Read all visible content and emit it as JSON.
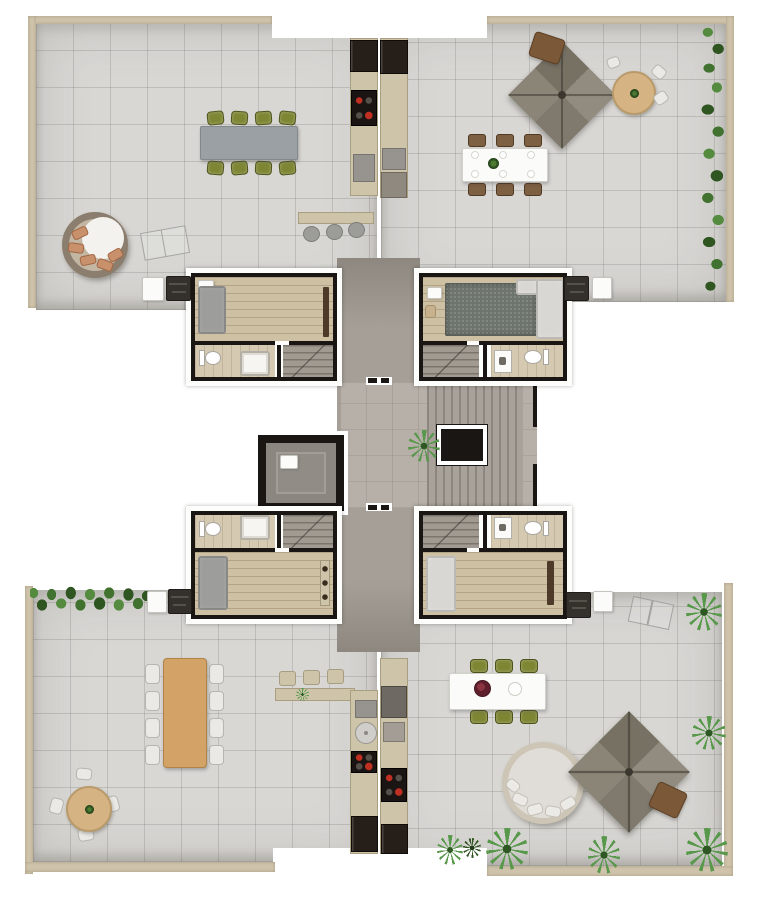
{
  "scene": {
    "kind": "rendered-floor-plan-top-view",
    "description_items": [
      "four terrace units",
      "central elevator and stair core",
      "no text labels visible"
    ]
  },
  "palette": {
    "wall_beige": "#cfc3ab",
    "tile": "#d8d7d4",
    "tile_line": "rgba(125,122,116,0.28)",
    "core": "#a59f97",
    "corridor": "#b6b0a8",
    "wood_floor": "#cec0a3",
    "wood_table": "#d3a267",
    "table_gray": "#9aa0a3",
    "chair_green": "#7e8634",
    "chair_brown": "#7d5f41",
    "chair_white": "#eae9e5",
    "hedge_dark": "#2f5521",
    "hedge_mid": "#41722f",
    "hedge_light": "#558b3f",
    "palm_green": "#57984a",
    "pergola": "#8b8679",
    "pillow_salmon": "#c9906c",
    "sofa_gray": "#9d9d9b",
    "sofa_light": "#d9d7d3",
    "rug": "#6e746d",
    "bath_floor": "#d5c9b1",
    "stairs": "#a19a91",
    "wall_black": "#1a1613",
    "appliance_dark": "#261e19",
    "steel": "#97948f",
    "counter": "#cec4aa",
    "daybed_rim": "#8b7e6e",
    "burner_red": "#bf2f22",
    "white": "#ffffff"
  },
  "units": [
    {
      "id": "upper-left",
      "outdoor_items": [
        "8-seat dining table with green chairs",
        "round daybed with salmon cushions",
        "outdoor kitchen: fridge, cooktop, sink",
        "bar counter with 3 stools",
        "barbecue grill",
        "white side cabinet",
        "sketched lounger outline"
      ],
      "indoor_items": [
        "gray sofa",
        "media console",
        "wardrobe",
        "bathroom: toilet + shower",
        "staircase"
      ]
    },
    {
      "id": "upper-right",
      "outdoor_items": [
        "square pergola parasol",
        "small wooden bistro table",
        "round table with white chairs",
        "6-seat white dining table with plates",
        "outdoor kitchen: fridge, sink, cabinet",
        "barbecue grill",
        "white side cabinet",
        "hedge along right edge"
      ],
      "indoor_items": [
        "mottled rug",
        "light corner sofa",
        "side table and chair",
        "bathroom: toilet + washer",
        "staircase"
      ]
    },
    {
      "id": "lower-left",
      "outdoor_items": [
        "8-seat wooden dining table with white chairs",
        "round table with 4 white chairs",
        "bar counter with 3 stools and plant",
        "outdoor kitchen: sink, round basin, cooktop, fridge",
        "barbecue grill",
        "white side cabinet",
        "hedge along top edge"
      ],
      "indoor_items": [
        "gray corner sofa",
        "kitchenette strip with burners",
        "bathroom: toilet + shower",
        "staircase"
      ]
    },
    {
      "id": "lower-right",
      "outdoor_items": [
        "6-seat white dining table with green chairs, flower centerpiece and bowl",
        "round daybed with white cushions",
        "square pergola parasol",
        "small wooden bistro table",
        "outdoor kitchen: appliances, cooktop with red knobs, fridge",
        "barbecue grill",
        "white side cabinet",
        "palm plants",
        "sketched lounger outline"
      ],
      "indoor_items": [
        "light corner sofa",
        "dark console",
        "bathroom: toilet + washer",
        "staircase"
      ]
    }
  ],
  "core": {
    "items": [
      "elevator shaft",
      "stair treads",
      "black floor opening with white frame",
      "potted plant",
      "unit entry doors"
    ]
  }
}
